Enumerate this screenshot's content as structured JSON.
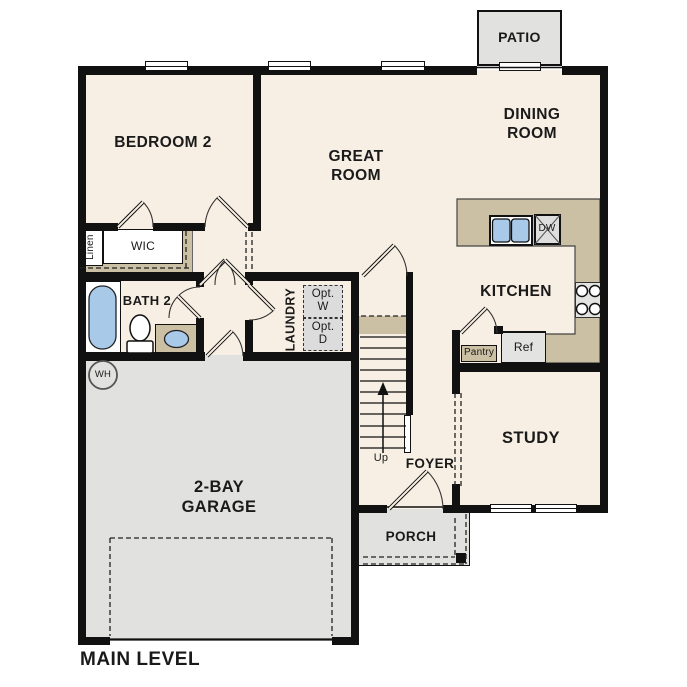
{
  "title": "MAIN LEVEL",
  "colors": {
    "wall": "#111111",
    "floor": "#f7efe3",
    "counter": "#cbbfa4",
    "area": "#e1e1df",
    "blue": "#a9c9e9",
    "appliance": "#e3e3e1"
  },
  "rooms": {
    "patio": {
      "label": "PATIO"
    },
    "bedroom2": {
      "label": "BEDROOM 2"
    },
    "great_room": {
      "label": "GREAT\nROOM"
    },
    "dining_room": {
      "label": "DINING\nROOM"
    },
    "kitchen": {
      "label": "KITCHEN"
    },
    "study": {
      "label": "STUDY"
    },
    "foyer": {
      "label": "FOYER"
    },
    "porch": {
      "label": "PORCH"
    },
    "garage": {
      "label": "2-BAY\nGARAGE"
    },
    "bath2": {
      "label": "BATH 2"
    },
    "wic": {
      "label": "WIC"
    },
    "linen": {
      "label": "Linen"
    },
    "laundry": {
      "label": "LAUNDRY"
    }
  },
  "annotations": {
    "up": "Up",
    "wh": "WH",
    "dw": "DW",
    "ref": "Ref",
    "pantry": "Pantry",
    "opt_w": "Opt.\nW",
    "opt_d": "Opt.\nD"
  }
}
